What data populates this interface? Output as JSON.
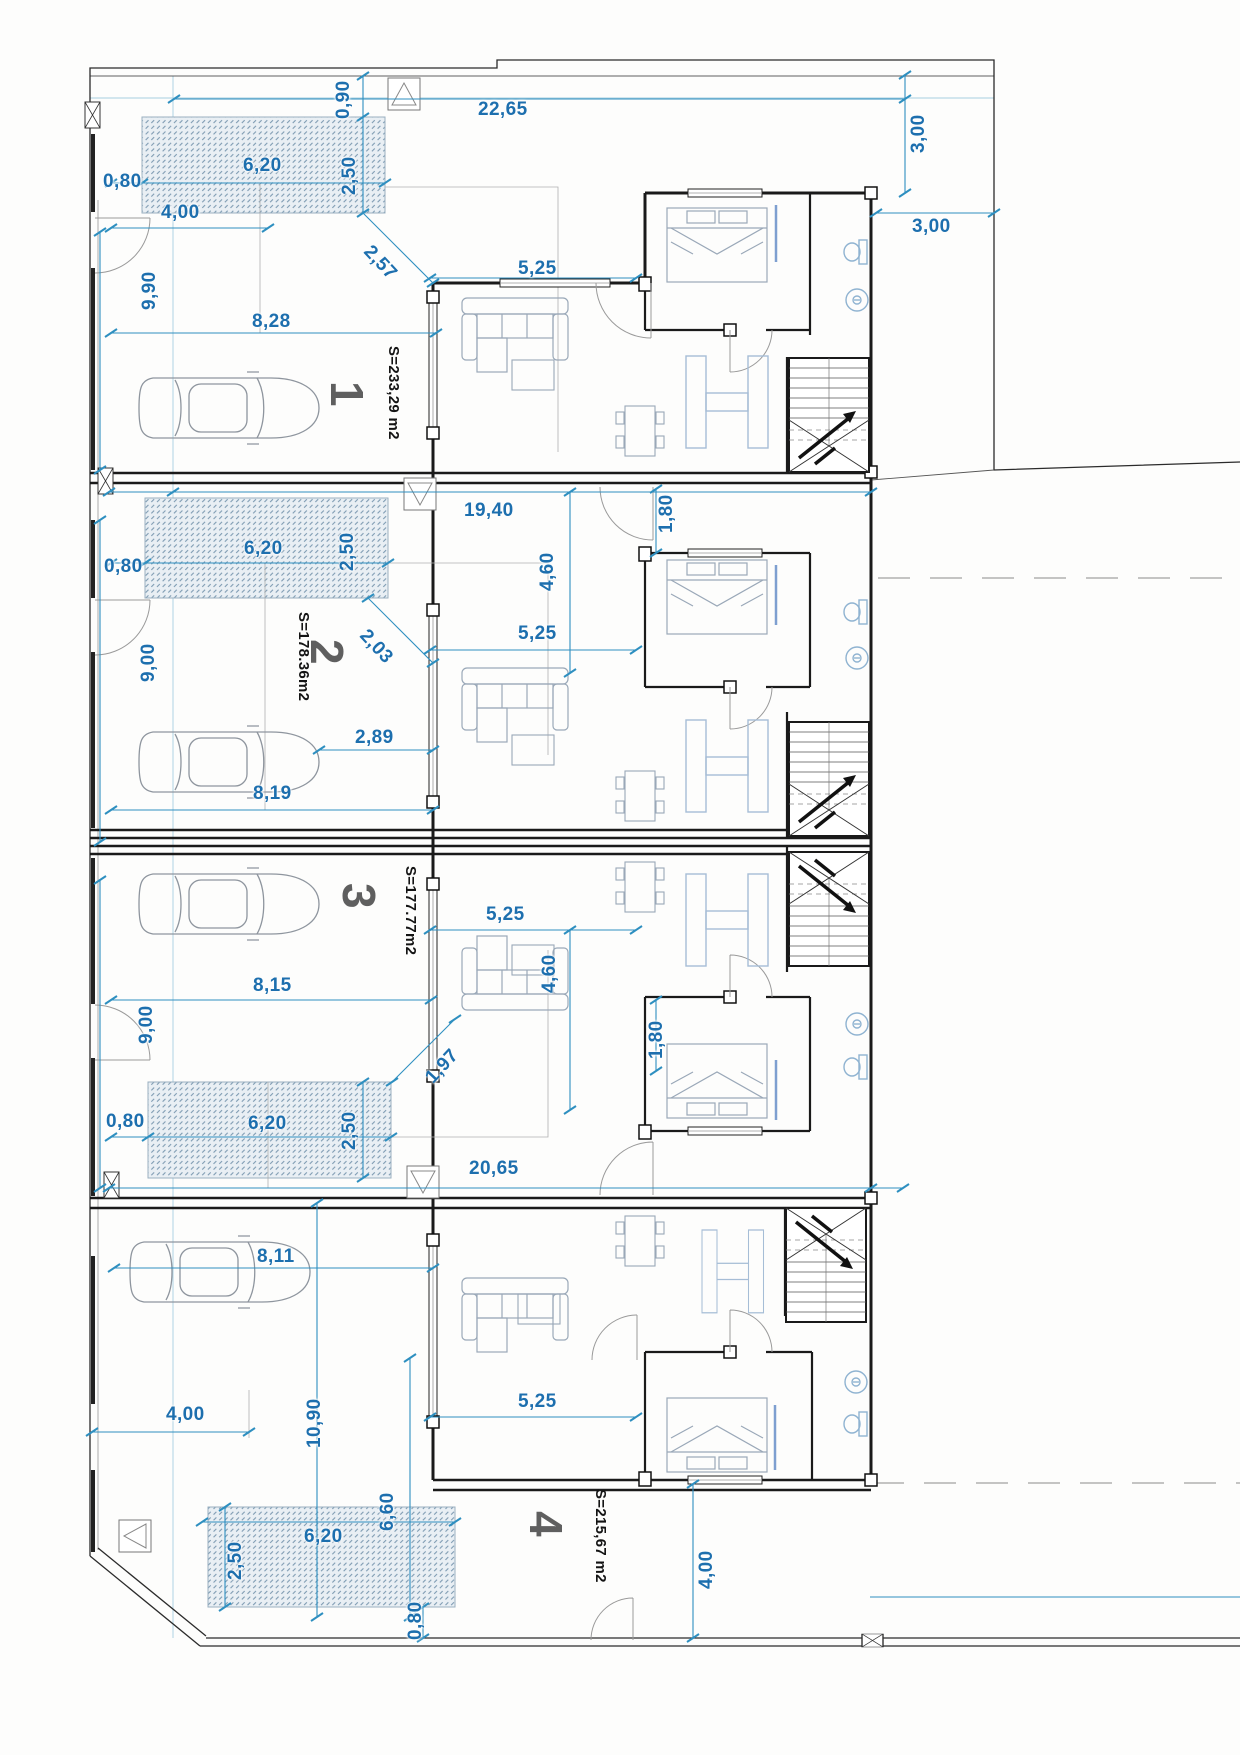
{
  "plan": {
    "type": "architectural-floor-plan",
    "units": [
      {
        "number": "1",
        "area_label": "S=233,29 m2",
        "dims": {
          "w090": "0,90",
          "w2265": "22,65",
          "v300": "3,00",
          "h300": "3,00",
          "w620": "6,20",
          "v250": "2,50",
          "w080": "0,80",
          "w400": "4,00",
          "v990": "9,90",
          "d257": "2,57",
          "w828": "8,28",
          "w525": "5,25"
        }
      },
      {
        "number": "2",
        "area_label": "S=178.36m2",
        "dims": {
          "w1940": "19,40",
          "v180": "1,80",
          "v460": "4,60",
          "w620": "6,20",
          "v250": "2,50",
          "w080": "0,80",
          "v900": "9,00",
          "d203": "2,03",
          "w525": "5,25",
          "w289": "2,89",
          "w819": "8,19"
        }
      },
      {
        "number": "3",
        "area_label": "S=177.77m2",
        "dims": {
          "w815": "8,15",
          "w525": "5,25",
          "v460": "4,60",
          "v180": "1,80",
          "d197": "1,97",
          "w080": "0,80",
          "w620": "6,20",
          "v250": "2,50",
          "v900": "9,00",
          "w2065": "20,65"
        }
      },
      {
        "number": "4",
        "area_label": "S=215,67 m2",
        "dims": {
          "w811": "8,11",
          "w400": "4,00",
          "v1090": "10,90",
          "v660": "6,60",
          "w620": "6,20",
          "v250": "2,50",
          "v080": "0,80",
          "w525": "5,25",
          "v400": "4,00"
        }
      }
    ],
    "colors": {
      "dimension_text": "#1d6fae",
      "dimension_line": "#2e8fc0",
      "guide_line": "#a8cfe0",
      "area_text": "#141414",
      "unit_number": "#5f5f5f",
      "wall": "#1a1a1a",
      "fixture": "#8fb3d1",
      "kitchen": "#a6bdd6",
      "furniture": "#9aa8b8",
      "hatch_fill": "#e9eff4",
      "hatch_stroke": "#7f9cb3"
    }
  }
}
